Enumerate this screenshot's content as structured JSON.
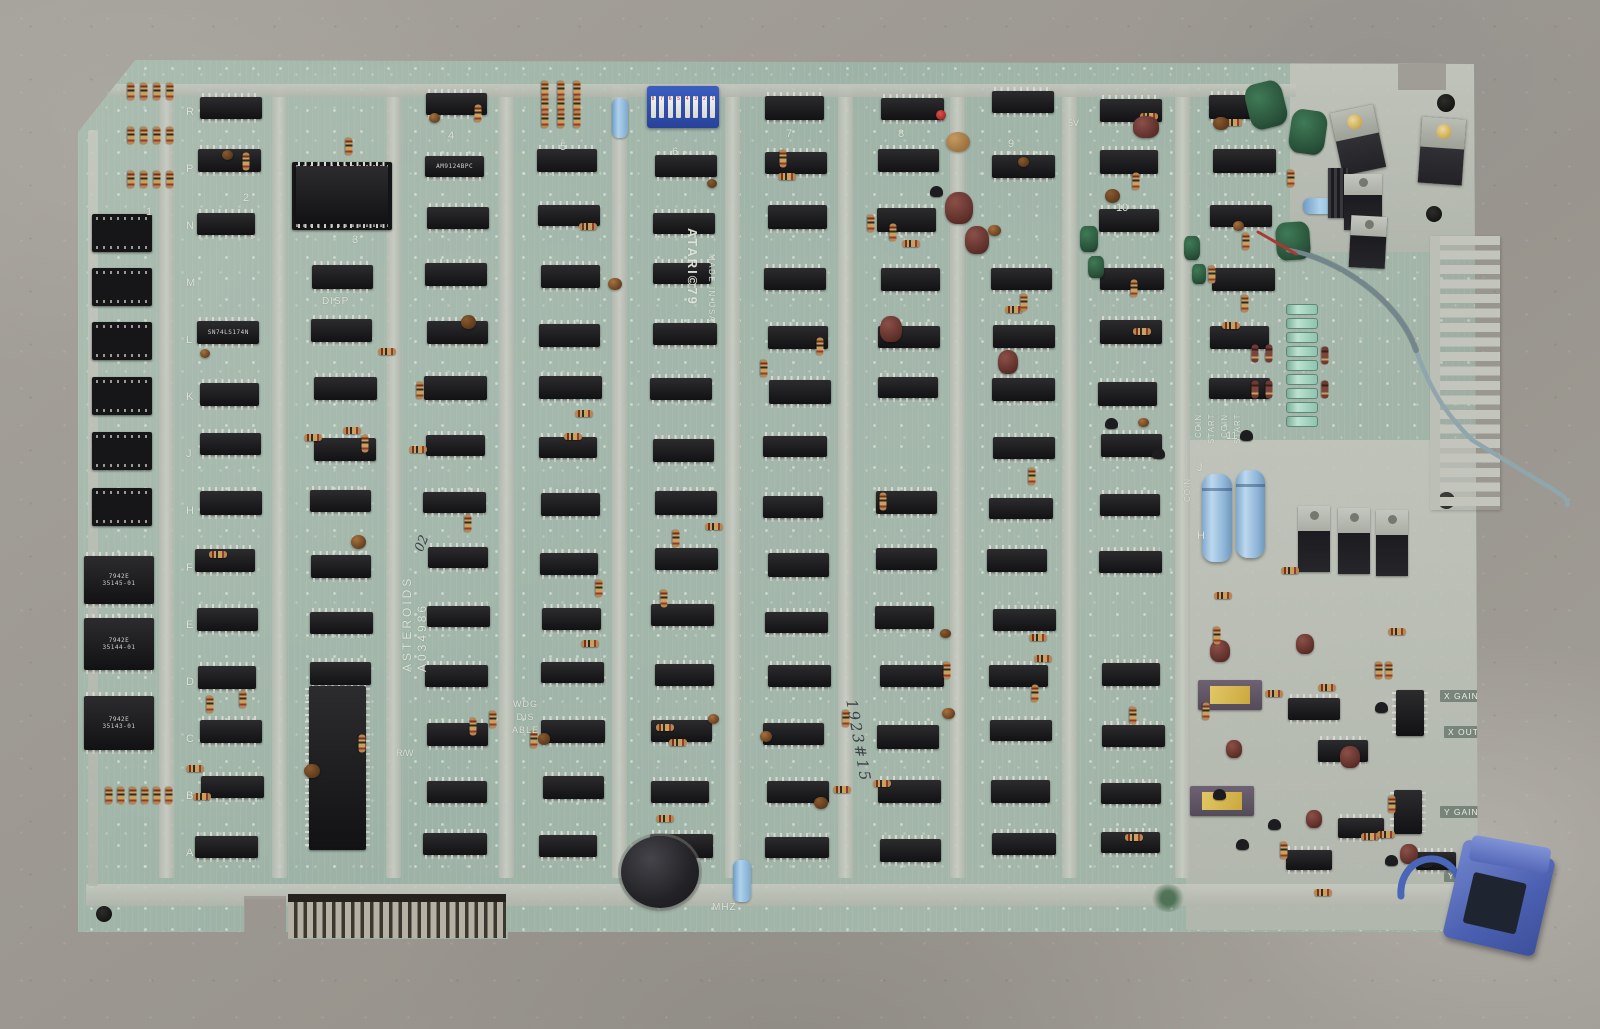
{
  "pcb": {
    "silkscreen_labels": {
      "brand_line1": "ATARI©79",
      "brand_line2": "MADE IN USA",
      "board_title": "ASTEROIDS",
      "assembly_number": "A034986",
      "disp": "DISP",
      "mhz": "MHZ",
      "read_write": "R/W",
      "five_v": "5V",
      "watchdog": [
        "WDG",
        "DIS",
        "ABLE"
      ],
      "coin_start_column": [
        "COIN",
        "START",
        "COIN",
        "START"
      ],
      "coin_lower": "COIN",
      "x_gain": "X GAIN",
      "x_out": "X OUT",
      "y_gain": "Y GAIN",
      "y_out": "Y OUT",
      "row_letters": [
        "R",
        "P",
        "N",
        "M",
        "L",
        "K",
        "J",
        "H",
        "F",
        "E",
        "D",
        "C",
        "B",
        "A"
      ],
      "right_row_letters": [
        "J",
        "H"
      ],
      "column_numbers": [
        "1",
        "2",
        "3",
        "4",
        "5",
        "6",
        "7",
        "8",
        "9",
        "10",
        "11"
      ]
    },
    "handwritten_marks": {
      "assembly_suffix": "02",
      "rework_mark": "1923#15"
    },
    "ic_labels": {
      "eprom_vendor": "7942E",
      "eprom_labels": [
        "35145-01",
        "35144-01",
        "35143-01"
      ],
      "ram_label": "AM9124BPC",
      "logic_label": "SN74LS174N",
      "dip_switch_numbers": [
        "8",
        "7",
        "6",
        "5",
        "4",
        "3",
        "2",
        "1"
      ]
    },
    "colors": {
      "board_green": "#a3b7a9",
      "silkscreen_silver": "#c6cabf",
      "ic_black": "#18181a",
      "electrolytic_blue": "#a9cce6",
      "clip_blue": "#5d74c4",
      "floor_gray": "#a29e98",
      "capacitor_green": "#2e5c3f",
      "capacitor_maroon": "#6b3a33",
      "dip_switch_blue": "#2f55b0",
      "ceramic_gold": "#d2b14e"
    }
  }
}
